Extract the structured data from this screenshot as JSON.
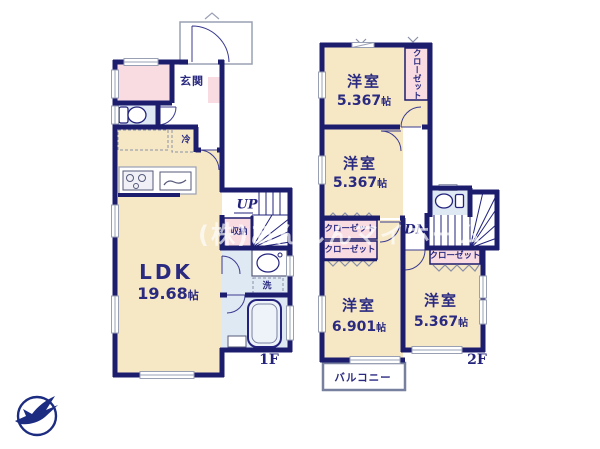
{
  "watermark": {
    "text": "(株)あんしんマイホーム"
  },
  "labels": {
    "closet": "クローゼット",
    "storage": "収納",
    "entrance": "玄関",
    "fridge": "冷",
    "laundry": "洗",
    "balcony": "バルコニー",
    "up": "UP",
    "dn": "DN"
  },
  "floor1": {
    "tag": "1F",
    "ldk": {
      "name": "LDK",
      "size_num": "19.68",
      "size_unit": "帖"
    }
  },
  "floor2": {
    "tag": "2F",
    "rooms": [
      {
        "name": "洋室",
        "size_num": "5.367",
        "size_unit": "帖"
      },
      {
        "name": "洋室",
        "size_num": "5.367",
        "size_unit": "帖"
      },
      {
        "name": "洋室",
        "size_num": "6.901",
        "size_unit": "帖"
      },
      {
        "name": "洋室",
        "size_num": "5.367",
        "size_unit": "帖"
      }
    ]
  },
  "colors": {
    "wall": "#1d1d6e",
    "room_fill": "#f6e7c5",
    "closet_fill": "#f9dce2",
    "wet_area_fill": "#dfe9f4",
    "label_text": "#2a2a80",
    "watermark": "rgba(255,255,255,0.68)"
  }
}
